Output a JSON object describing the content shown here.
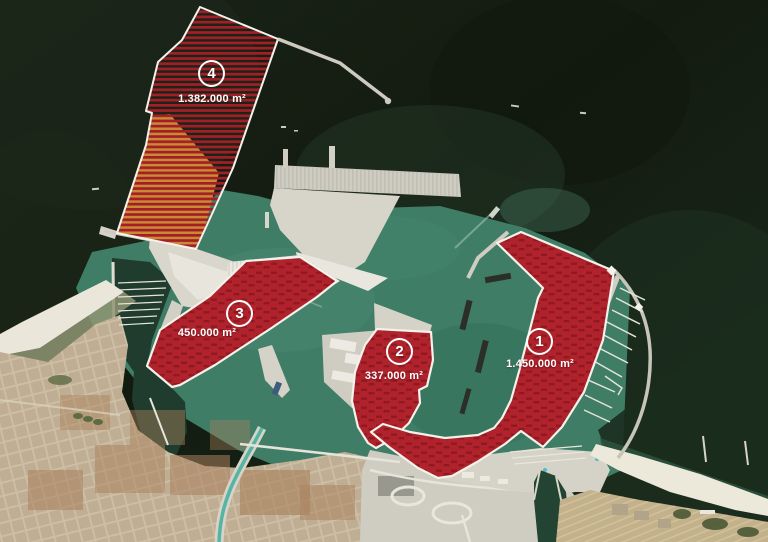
{
  "zones": [
    {
      "number": "1",
      "area": "1.450.000 m²"
    },
    {
      "number": "2",
      "area": "337.000 m²"
    },
    {
      "number": "3",
      "area": "450.000 m²"
    },
    {
      "number": "4",
      "area": "1.382.000 m²"
    }
  ],
  "colors": {
    "zone_fill": "#b1232c",
    "zone_border": "#f4f2ea",
    "hatch_red": "#a51e27",
    "hatch_sand": "#c98a34",
    "sea_dark": "#141c12",
    "harbor_water": "#3f7d66",
    "inner_harbor": "#1f3c2f",
    "land_light": "#d7d4ca",
    "land_bright": "#e9e7de",
    "city": "#bfae93",
    "beach": "#eae6d9",
    "fields": "#c2b18a",
    "canal": "#55b4a2"
  }
}
